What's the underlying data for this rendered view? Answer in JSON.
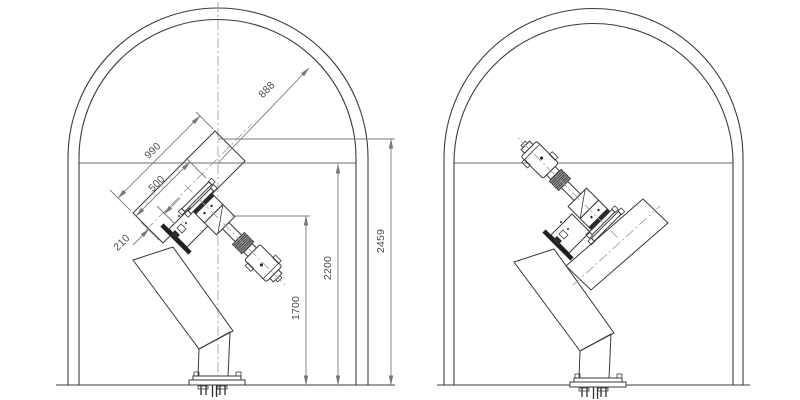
{
  "diagram": {
    "title": "tunnel-manipulator-cad-drawing",
    "views": {
      "left": "section-with-dimensions",
      "right": "section-alternate-pose"
    },
    "dimensions": {
      "boom_length": "990",
      "boom_inner_length": "500",
      "flange_offset": "210",
      "arch_radius": "888",
      "pivot_height": "1700",
      "wall_height": "2200",
      "overall_height": "2459"
    },
    "colors": {
      "line": "#3c3c3c",
      "dimension_line": "#7b7b7b",
      "centerline": "#9b9b9b",
      "text": "#4c4c4c",
      "background": "#ffffff"
    }
  }
}
